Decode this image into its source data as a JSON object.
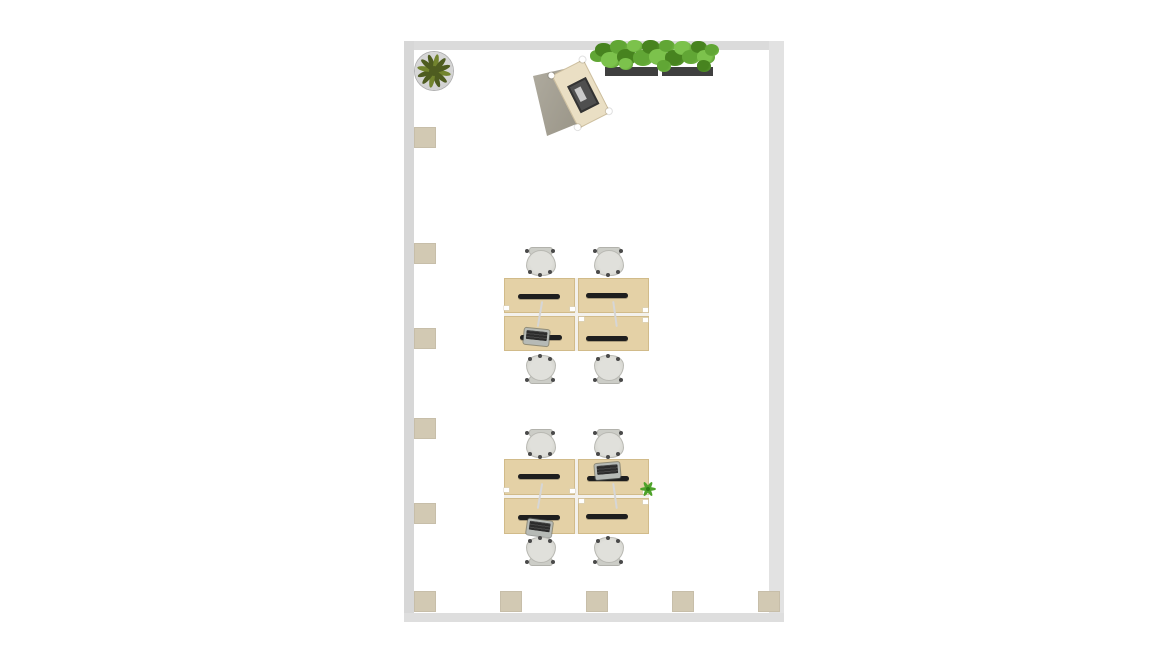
{
  "scene": {
    "kind": "floor-plan-2d-top-view",
    "canvas_width": 1166,
    "canvas_height": 656,
    "background": "#ffffff"
  },
  "palette": {
    "wall": "#dbdbdb",
    "wall_light": "#e2e2e2",
    "pillar": "#d2c9b3",
    "desk": "#e4d1a6",
    "desk_seam": "#f3f1ec",
    "monitor": "#1e1e1e",
    "chair_seat": "#d8d8d3",
    "pot": "#c9c9c9",
    "pot_border": "#b0b0b0",
    "foliage_dark": "#4e5c20",
    "foliage_light": "#72842e",
    "hedge_greens": [
      "#47831f",
      "#61a635",
      "#7cc24c"
    ],
    "planter": "#3f3f3f",
    "reception_desk": "#eadfc4",
    "reception_panel_from": "#b0aca0",
    "reception_panel_to": "#8f8a7c",
    "reception_screen": "#c9c9c9",
    "reception_frame": "#4f4f4f",
    "accent_plant": "#4ea22a",
    "accent_plant_dark": "#2e7d14"
  },
  "room": {
    "x": 404,
    "y": 41,
    "w": 380,
    "h": 581
  },
  "walls": [
    {
      "side": "top",
      "x": 404,
      "y": 41,
      "w": 380,
      "h": 9,
      "color": "#dbdbdb"
    },
    {
      "side": "left",
      "x": 404,
      "y": 41,
      "w": 10,
      "h": 581,
      "color": "#d7d7d7"
    },
    {
      "side": "right",
      "x": 769,
      "y": 41,
      "w": 15,
      "h": 581,
      "color": "#e2e2e2"
    },
    {
      "side": "bottom",
      "x": 404,
      "y": 613,
      "w": 380,
      "h": 9,
      "color": "#dedede"
    }
  ],
  "pillars": {
    "w": 22,
    "h": 21,
    "positions": [
      [
        414,
        127
      ],
      [
        414,
        243
      ],
      [
        414,
        328
      ],
      [
        414,
        418
      ],
      [
        414,
        503
      ],
      [
        414,
        591
      ],
      [
        500,
        591
      ],
      [
        586,
        591
      ],
      [
        672,
        591
      ],
      [
        758,
        591
      ]
    ]
  },
  "potted_plant": {
    "x": 415,
    "y": 52,
    "size": 38,
    "leaves": 12
  },
  "reception": {
    "x": 531,
    "y": 62,
    "w": 82,
    "h": 78,
    "panel_points": [
      [
        2,
        14
      ],
      [
        46,
        4
      ],
      [
        60,
        56
      ],
      [
        16,
        74
      ]
    ],
    "desk": {
      "x": 32,
      "y": 2,
      "w": 36,
      "h": 60,
      "rot": -27
    },
    "monitor": {
      "x": 9,
      "y": 17,
      "w": 17,
      "h": 26
    },
    "corner_dots": [
      [
        -3,
        -3
      ],
      [
        32,
        -3
      ],
      [
        -3,
        55
      ],
      [
        32,
        55
      ]
    ]
  },
  "hedge": {
    "planters": [
      [
        605,
        67,
        53,
        9
      ],
      [
        662,
        67,
        51,
        9
      ]
    ],
    "bushes": [
      [
        598,
        56,
        8,
        1
      ],
      [
        604,
        50,
        9,
        0
      ],
      [
        611,
        60,
        10,
        2
      ],
      [
        619,
        47,
        9,
        1
      ],
      [
        627,
        57,
        10,
        0
      ],
      [
        635,
        46,
        8,
        2
      ],
      [
        643,
        58,
        10,
        1
      ],
      [
        651,
        47,
        9,
        0
      ],
      [
        659,
        57,
        10,
        2
      ],
      [
        667,
        46,
        8,
        1
      ],
      [
        675,
        58,
        10,
        0
      ],
      [
        683,
        48,
        9,
        2
      ],
      [
        691,
        57,
        9,
        1
      ],
      [
        699,
        47,
        8,
        0
      ],
      [
        706,
        57,
        9,
        2
      ],
      [
        712,
        50,
        7,
        1
      ],
      [
        704,
        66,
        7,
        0
      ],
      [
        626,
        64,
        7,
        2
      ],
      [
        664,
        66,
        7,
        1
      ]
    ]
  },
  "desk_clusters": [
    {
      "x": 504,
      "y": 278,
      "desk_w": 71,
      "desk_h": 35,
      "seam": 3
    },
    {
      "x": 504,
      "y": 459,
      "desk_w": 71,
      "desk_h": 36,
      "seam": 3
    }
  ],
  "monitors": [
    [
      518,
      294
    ],
    [
      586,
      293
    ],
    [
      520,
      335
    ],
    [
      586,
      336
    ],
    [
      518,
      474
    ],
    [
      587,
      476
    ],
    [
      518,
      515
    ],
    [
      586,
      514
    ]
  ],
  "laptops": [
    [
      524,
      329,
      6
    ],
    [
      595,
      463,
      -5
    ],
    [
      527,
      520,
      8
    ]
  ],
  "chairs": [
    [
      524,
      247,
      0
    ],
    [
      592,
      247,
      0
    ],
    [
      524,
      355,
      1
    ],
    [
      592,
      355,
      1
    ],
    [
      524,
      429,
      0
    ],
    [
      592,
      429,
      0
    ],
    [
      524,
      537,
      1
    ],
    [
      592,
      537,
      1
    ]
  ],
  "desk_plant": {
    "x": 639,
    "y": 480
  }
}
